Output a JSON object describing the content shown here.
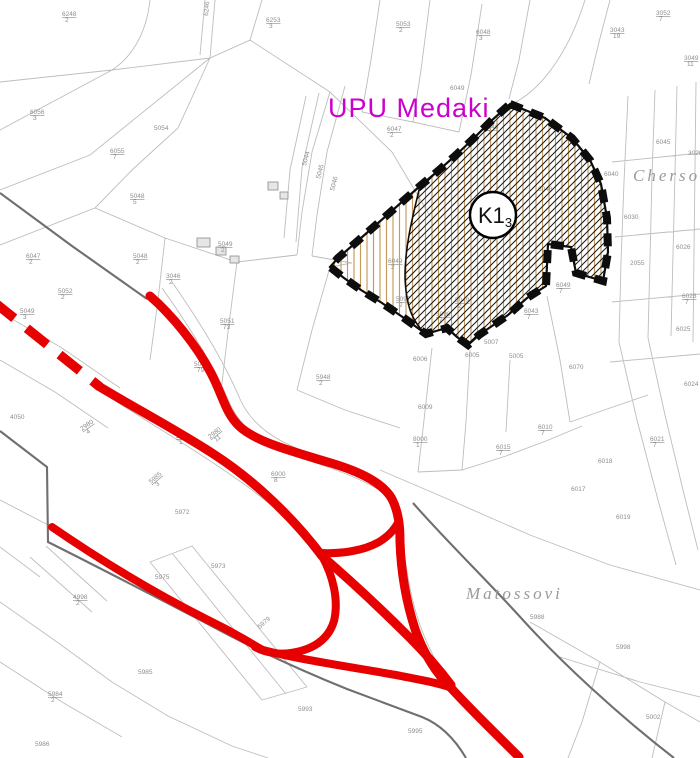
{
  "map": {
    "plan_label": "UPU Medaki",
    "zone_badge": {
      "main": "K1",
      "sub": "3"
    },
    "place_names": [
      {
        "text": "Chersoli"
      },
      {
        "text": "Matossovi"
      }
    ],
    "parcels": [
      {
        "x": 62,
        "y": 16,
        "n": "6248",
        "d": "2"
      },
      {
        "x": 208,
        "y": 16,
        "n": "6246",
        "r": -85
      },
      {
        "x": 266,
        "y": 22,
        "n": "6253",
        "d": "3"
      },
      {
        "x": 396,
        "y": 26,
        "n": "5053",
        "d": "2"
      },
      {
        "x": 476,
        "y": 34,
        "n": "6048",
        "d": "3"
      },
      {
        "x": 610,
        "y": 32,
        "n": "3043",
        "d": "19"
      },
      {
        "x": 656,
        "y": 15,
        "n": "3052",
        "d": "7"
      },
      {
        "x": 684,
        "y": 60,
        "n": "3049",
        "d": "11"
      },
      {
        "x": 688,
        "y": 155,
        "n": "3028"
      },
      {
        "x": 656,
        "y": 144,
        "n": "6045"
      },
      {
        "x": 604,
        "y": 176,
        "n": "6040"
      },
      {
        "x": 624,
        "y": 219,
        "n": "6030"
      },
      {
        "x": 676,
        "y": 249,
        "n": "6026"
      },
      {
        "x": 630,
        "y": 265,
        "n": "2055"
      },
      {
        "x": 682,
        "y": 298,
        "n": "6028",
        "d": "7"
      },
      {
        "x": 676,
        "y": 331,
        "n": "6025"
      },
      {
        "x": 684,
        "y": 386,
        "n": "6024"
      },
      {
        "x": 650,
        "y": 441,
        "n": "6021",
        "d": "7"
      },
      {
        "x": 598,
        "y": 463,
        "n": "6018"
      },
      {
        "x": 616,
        "y": 519,
        "n": "6019"
      },
      {
        "x": 538,
        "y": 429,
        "n": "6010",
        "d": "7"
      },
      {
        "x": 496,
        "y": 449,
        "n": "6015",
        "d": "7"
      },
      {
        "x": 571,
        "y": 491,
        "n": "6017"
      },
      {
        "x": 450,
        "y": 90,
        "n": "6049"
      },
      {
        "x": 484,
        "y": 129,
        "n": "6046",
        "d": "7"
      },
      {
        "x": 387,
        "y": 131,
        "n": "6047",
        "d": "2"
      },
      {
        "x": 538,
        "y": 191,
        "n": "6048"
      },
      {
        "x": 455,
        "y": 302,
        "n": "5049",
        "d": "2"
      },
      {
        "x": 388,
        "y": 263,
        "n": "6049",
        "d": "2"
      },
      {
        "x": 396,
        "y": 301,
        "n": "5097",
        "d": "2"
      },
      {
        "x": 436,
        "y": 316,
        "n": "5098",
        "d": "7"
      },
      {
        "x": 556,
        "y": 287,
        "n": "6049",
        "d": "7"
      },
      {
        "x": 524,
        "y": 313,
        "n": "6043",
        "d": "7"
      },
      {
        "x": 413,
        "y": 361,
        "n": "6006"
      },
      {
        "x": 465,
        "y": 357,
        "n": "6005"
      },
      {
        "x": 484,
        "y": 344,
        "n": "5007"
      },
      {
        "x": 509,
        "y": 358,
        "n": "5005"
      },
      {
        "x": 569,
        "y": 369,
        "n": "6070"
      },
      {
        "x": 154,
        "y": 130,
        "n": "5054"
      },
      {
        "x": 110,
        "y": 153,
        "n": "6055",
        "d": "7"
      },
      {
        "x": 30,
        "y": 114,
        "n": "6056",
        "d": "3"
      },
      {
        "x": 306,
        "y": 166,
        "n": "5044",
        "r": -75
      },
      {
        "x": 320,
        "y": 179,
        "n": "5045",
        "r": -75
      },
      {
        "x": 334,
        "y": 191,
        "n": "5046",
        "r": -75
      },
      {
        "x": 218,
        "y": 246,
        "n": "5049",
        "d": "2"
      },
      {
        "x": 130,
        "y": 198,
        "n": "5048",
        "d": "5"
      },
      {
        "x": 26,
        "y": 258,
        "n": "6047",
        "d": "2"
      },
      {
        "x": 58,
        "y": 293,
        "n": "5052",
        "d": "2"
      },
      {
        "x": 133,
        "y": 258,
        "n": "5048",
        "d": "2"
      },
      {
        "x": 166,
        "y": 278,
        "n": "3046",
        "d": "2"
      },
      {
        "x": 20,
        "y": 313,
        "n": "5049",
        "d": "3"
      },
      {
        "x": 220,
        "y": 323,
        "n": "5051",
        "d": "73"
      },
      {
        "x": 194,
        "y": 366,
        "n": "5051",
        "d": "79"
      },
      {
        "x": 10,
        "y": 419,
        "n": "4050"
      },
      {
        "x": 316,
        "y": 379,
        "n": "5948",
        "d": "2"
      },
      {
        "x": 271,
        "y": 476,
        "n": "6000",
        "d": "8"
      },
      {
        "x": 413,
        "y": 441,
        "n": "8000",
        "d": "1"
      },
      {
        "x": 418,
        "y": 409,
        "n": "6009"
      },
      {
        "x": 176,
        "y": 438,
        "n": "2980",
        "d": "1"
      },
      {
        "x": 210,
        "y": 439,
        "n": "2980",
        "d": "11",
        "r": -38
      },
      {
        "x": 82,
        "y": 431,
        "n": "2980",
        "d": "4",
        "r": -35
      },
      {
        "x": 151,
        "y": 484,
        "n": "5985",
        "d": "3",
        "r": -40
      },
      {
        "x": 175,
        "y": 514,
        "n": "5972"
      },
      {
        "x": 155,
        "y": 579,
        "n": "5975"
      },
      {
        "x": 211,
        "y": 568,
        "n": "5973"
      },
      {
        "x": 73,
        "y": 599,
        "n": "4998",
        "d": "2"
      },
      {
        "x": 138,
        "y": 674,
        "n": "5985"
      },
      {
        "x": 48,
        "y": 696,
        "n": "5984",
        "d": "2"
      },
      {
        "x": 35,
        "y": 746,
        "n": "5986"
      },
      {
        "x": 260,
        "y": 629,
        "n": "5979",
        "r": -42
      },
      {
        "x": 530,
        "y": 619,
        "n": "5988"
      },
      {
        "x": 646,
        "y": 719,
        "n": "5002"
      },
      {
        "x": 616,
        "y": 649,
        "n": "5998"
      },
      {
        "x": 408,
        "y": 733,
        "n": "5995"
      },
      {
        "x": 298,
        "y": 711,
        "n": "5993"
      }
    ]
  },
  "colors": {
    "road_red": "#e60000",
    "plan_magenta": "#cc00cc",
    "hatch_tan": "#c49a5a",
    "hatch_diag": "#1a1a1a",
    "boundary_black": "#0d0d0d",
    "parcel_line": "#bdbdbd",
    "parcel_label": "#8e8e8e",
    "place_label": "#9a9a9a",
    "dark_line": "#6f6f6f",
    "building_fill": "#e6e6e6",
    "background": "#ffffff"
  }
}
